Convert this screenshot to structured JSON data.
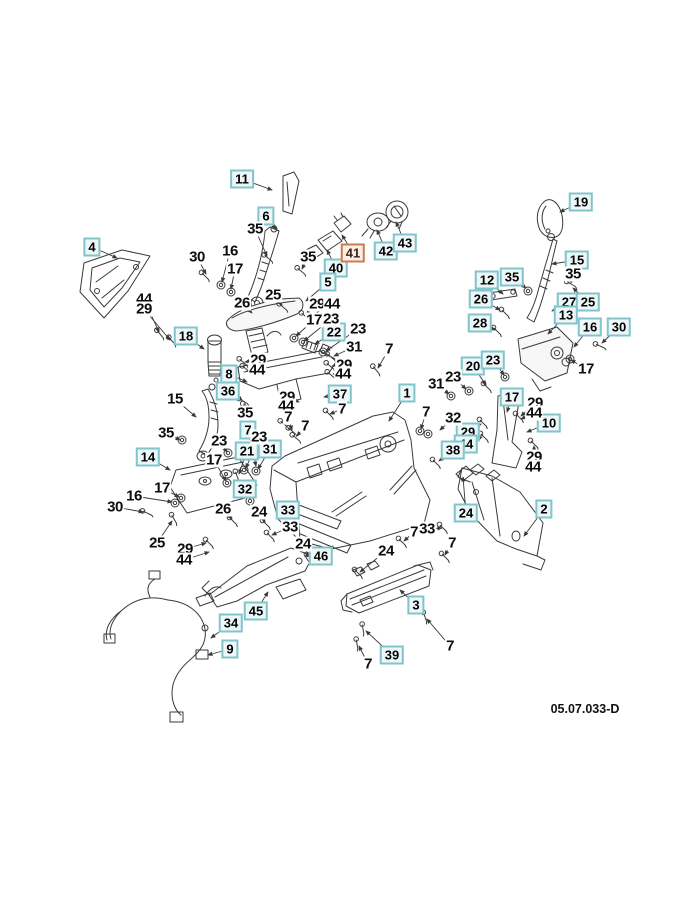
{
  "drawing_number": "05.07.033-D",
  "colors": {
    "box_border": "#82c4cc",
    "box_background": "#eef7f8",
    "highlight_border": "#cd7b4e",
    "highlight_background": "#f9efe7",
    "line": "#3a3a3a",
    "page_background": "#ffffff"
  },
  "callouts": [
    {
      "n": "11",
      "x": 242,
      "y": 179,
      "s": "b",
      "lx": 272,
      "ly": 190
    },
    {
      "n": "6",
      "x": 266,
      "y": 216,
      "s": "b",
      "lx": 276,
      "ly": 229
    },
    {
      "n": "4",
      "x": 92,
      "y": 247,
      "s": "b",
      "lx": 117,
      "ly": 258
    },
    {
      "n": "40",
      "x": 336,
      "y": 268,
      "s": "b",
      "lx": 327,
      "ly": 250
    },
    {
      "n": "41",
      "x": 353,
      "y": 253,
      "s": "h",
      "lx": 342,
      "ly": 235
    },
    {
      "n": "42",
      "x": 386,
      "y": 251,
      "s": "b",
      "lx": 377,
      "ly": 230
    },
    {
      "n": "43",
      "x": 405,
      "y": 243,
      "s": "b",
      "lx": 396,
      "ly": 222
    },
    {
      "n": "19",
      "x": 581,
      "y": 202,
      "s": "b",
      "lx": 560,
      "ly": 212
    },
    {
      "n": "5",
      "x": 328,
      "y": 282,
      "s": "b",
      "lx": 306,
      "ly": 301
    },
    {
      "n": "15",
      "x": 577,
      "y": 260,
      "s": "b",
      "lx": 552,
      "ly": 264
    },
    {
      "n": "35",
      "x": 512,
      "y": 277,
      "s": "b",
      "lx": 526,
      "ly": 288
    },
    {
      "n": "12",
      "x": 487,
      "y": 280,
      "s": "b",
      "lx": 503,
      "ly": 294
    },
    {
      "n": "26",
      "x": 481,
      "y": 299,
      "s": "b",
      "lx": 500,
      "ly": 310
    },
    {
      "n": "27",
      "x": 569,
      "y": 302,
      "s": "b",
      "lx": 552,
      "ly": 311
    },
    {
      "n": "25",
      "x": 588,
      "y": 302,
      "s": "b",
      "lx": 573,
      "ly": 288
    },
    {
      "n": "28",
      "x": 480,
      "y": 323,
      "s": "b",
      "lx": 495,
      "ly": 330
    },
    {
      "n": "13",
      "x": 566,
      "y": 315,
      "s": "b",
      "lx": 548,
      "ly": 334
    },
    {
      "n": "16",
      "x": 590,
      "y": 327,
      "s": "b",
      "lx": 574,
      "ly": 347
    },
    {
      "n": "30",
      "x": 619,
      "y": 327,
      "s": "b",
      "lx": 602,
      "ly": 343
    },
    {
      "n": "18",
      "x": 186,
      "y": 336,
      "s": "b",
      "lx": 204,
      "ly": 349
    },
    {
      "n": "22",
      "x": 334,
      "y": 332,
      "s": "b",
      "lx": 315,
      "ly": 344
    },
    {
      "n": "8",
      "x": 229,
      "y": 374,
      "s": "b",
      "lx": 247,
      "ly": 382
    },
    {
      "n": "36",
      "x": 228,
      "y": 391,
      "s": "b",
      "lx": 242,
      "ly": 400
    },
    {
      "n": "37",
      "x": 340,
      "y": 394,
      "s": "b",
      "lx": 324,
      "ly": 397
    },
    {
      "n": "1",
      "x": 407,
      "y": 393,
      "s": "b",
      "lx": 389,
      "ly": 421
    },
    {
      "n": "20",
      "x": 473,
      "y": 366,
      "s": "b",
      "lx": 486,
      "ly": 385
    },
    {
      "n": "23",
      "x": 493,
      "y": 360,
      "s": "b",
      "lx": 504,
      "ly": 375
    },
    {
      "n": "17",
      "x": 512,
      "y": 397,
      "s": "b",
      "lx": 507,
      "ly": 412
    },
    {
      "n": "10",
      "x": 549,
      "y": 423,
      "s": "b",
      "lx": 527,
      "ly": 432
    },
    {
      "n": "29",
      "x": 468,
      "y": 432,
      "s": "b",
      "lx": 481,
      "ly": 424
    },
    {
      "n": "44",
      "x": 466,
      "y": 444,
      "s": "b",
      "lx": 482,
      "ly": 437
    },
    {
      "n": "38",
      "x": 453,
      "y": 450,
      "s": "b",
      "lx": 439,
      "ly": 461
    },
    {
      "n": "14",
      "x": 148,
      "y": 457,
      "s": "b",
      "lx": 170,
      "ly": 470
    },
    {
      "n": "7",
      "x": 248,
      "y": 430,
      "s": "b",
      "lx": 256,
      "ly": 466
    },
    {
      "n": "21",
      "x": 247,
      "y": 451,
      "s": "b",
      "lx": 239,
      "ly": 474
    },
    {
      "n": "31",
      "x": 270,
      "y": 449,
      "s": "b",
      "lx": 258,
      "ly": 469
    },
    {
      "n": "32",
      "x": 245,
      "y": 489,
      "s": "b",
      "lx": 250,
      "ly": 499
    },
    {
      "n": "33",
      "x": 288,
      "y": 510,
      "s": "b",
      "lx": 299,
      "ly": 514
    },
    {
      "n": "2",
      "x": 544,
      "y": 509,
      "s": "b",
      "lx": 524,
      "ly": 536
    },
    {
      "n": "24",
      "x": 466,
      "y": 513,
      "s": "b",
      "lx": 463,
      "ly": 477
    },
    {
      "n": "46",
      "x": 321,
      "y": 556,
      "s": "b",
      "lx": 333,
      "ly": 546
    },
    {
      "n": "45",
      "x": 256,
      "y": 611,
      "s": "b",
      "lx": 268,
      "ly": 592
    },
    {
      "n": "34",
      "x": 231,
      "y": 623,
      "s": "b",
      "lx": 211,
      "ly": 638
    },
    {
      "n": "9",
      "x": 230,
      "y": 649,
      "s": "b",
      "lx": 208,
      "ly": 655
    },
    {
      "n": "3",
      "x": 416,
      "y": 605,
      "s": "b",
      "lx": 400,
      "ly": 590
    },
    {
      "n": "39",
      "x": 392,
      "y": 655,
      "s": "b",
      "lx": 366,
      "ly": 631
    },
    {
      "n": "30",
      "x": 197,
      "y": 257,
      "s": "p",
      "lx": 206,
      "ly": 274
    },
    {
      "n": "16",
      "x": 230,
      "y": 251,
      "s": "p",
      "lx": 222,
      "ly": 282
    },
    {
      "n": "17",
      "x": 235,
      "y": 269,
      "s": "p",
      "lx": 231,
      "ly": 289
    },
    {
      "n": "35",
      "x": 255,
      "y": 229,
      "s": "p",
      "lx": 267,
      "ly": 256
    },
    {
      "n": "35",
      "x": 308,
      "y": 257,
      "s": "p",
      "lx": 302,
      "ly": 269
    },
    {
      "n": "25",
      "x": 273,
      "y": 295,
      "s": "p",
      "lx": 282,
      "ly": 305
    },
    {
      "n": "26",
      "x": 242,
      "y": 303,
      "s": "p",
      "lx": 252,
      "ly": 313
    },
    {
      "n": "29",
      "x": 317,
      "y": 304,
      "s": "p",
      "lx": 306,
      "ly": 315
    },
    {
      "n": "44",
      "x": 332,
      "y": 304,
      "s": "p",
      "lx": 309,
      "ly": 317
    },
    {
      "n": "17",
      "x": 314,
      "y": 320,
      "s": "p",
      "lx": 296,
      "ly": 336
    },
    {
      "n": "23",
      "x": 331,
      "y": 319,
      "s": "p",
      "lx": 304,
      "ly": 341
    },
    {
      "n": "23",
      "x": 358,
      "y": 329,
      "s": "p",
      "lx": 326,
      "ly": 351
    },
    {
      "n": "31",
      "x": 354,
      "y": 347,
      "s": "p",
      "lx": 334,
      "ly": 356
    },
    {
      "n": "44",
      "x": 144,
      "y": 299,
      "s": "p",
      "lx": 159,
      "ly": 332
    },
    {
      "n": "29",
      "x": 144,
      "y": 309,
      "s": "p",
      "lx": 170,
      "ly": 340
    },
    {
      "n": "29",
      "x": 258,
      "y": 360,
      "s": "p",
      "lx": 245,
      "ly": 362
    },
    {
      "n": "44",
      "x": 257,
      "y": 370,
      "s": "p",
      "lx": 248,
      "ly": 369
    },
    {
      "n": "29",
      "x": 344,
      "y": 365,
      "s": "p",
      "lx": 332,
      "ly": 366
    },
    {
      "n": "44",
      "x": 343,
      "y": 374,
      "s": "p",
      "lx": 333,
      "ly": 374
    },
    {
      "n": "7",
      "x": 389,
      "y": 349,
      "s": "p",
      "lx": 378,
      "ly": 368
    },
    {
      "n": "15",
      "x": 175,
      "y": 399,
      "s": "p",
      "lx": 196,
      "ly": 417
    },
    {
      "n": "29",
      "x": 287,
      "y": 397,
      "s": "p",
      "lx": 299,
      "ly": 402
    },
    {
      "n": "44",
      "x": 286,
      "y": 406,
      "s": "p"
    },
    {
      "n": "35",
      "x": 245,
      "y": 413,
      "s": "p",
      "lx": 247,
      "ly": 406
    },
    {
      "n": "7",
      "x": 288,
      "y": 417,
      "s": "p",
      "lx": 292,
      "ly": 430
    },
    {
      "n": "7",
      "x": 305,
      "y": 426,
      "s": "p",
      "lx": 297,
      "ly": 436
    },
    {
      "n": "7",
      "x": 342,
      "y": 409,
      "s": "p",
      "lx": 330,
      "ly": 414
    },
    {
      "n": "35",
      "x": 166,
      "y": 433,
      "s": "p",
      "lx": 180,
      "ly": 440
    },
    {
      "n": "23",
      "x": 219,
      "y": 441,
      "s": "p",
      "lx": 227,
      "ly": 452
    },
    {
      "n": "23",
      "x": 259,
      "y": 437,
      "s": "p",
      "lx": 246,
      "ly": 468
    },
    {
      "n": "31",
      "x": 436,
      "y": 384,
      "s": "p",
      "lx": 449,
      "ly": 394
    },
    {
      "n": "23",
      "x": 453,
      "y": 377,
      "s": "p",
      "lx": 466,
      "ly": 389
    },
    {
      "n": "7",
      "x": 426,
      "y": 412,
      "s": "p",
      "lx": 421,
      "ly": 429
    },
    {
      "n": "32",
      "x": 453,
      "y": 418,
      "s": "p",
      "lx": 440,
      "ly": 430
    },
    {
      "n": "17",
      "x": 214,
      "y": 460,
      "s": "p",
      "lx": 226,
      "ly": 481
    },
    {
      "n": "17",
      "x": 162,
      "y": 488,
      "s": "p",
      "lx": 179,
      "ly": 497
    },
    {
      "n": "16",
      "x": 134,
      "y": 496,
      "s": "p",
      "lx": 172,
      "ly": 502
    },
    {
      "n": "30",
      "x": 115,
      "y": 507,
      "s": "p",
      "lx": 143,
      "ly": 512
    },
    {
      "n": "26",
      "x": 223,
      "y": 509,
      "s": "p",
      "lx": 232,
      "ly": 519
    },
    {
      "n": "24",
      "x": 259,
      "y": 512,
      "s": "p",
      "lx": 265,
      "ly": 522
    },
    {
      "n": "33",
      "x": 290,
      "y": 527,
      "s": "p",
      "lx": 272,
      "ly": 535
    },
    {
      "n": "25",
      "x": 157,
      "y": 543,
      "s": "p",
      "lx": 172,
      "ly": 521
    },
    {
      "n": "29",
      "x": 185,
      "y": 549,
      "s": "p",
      "lx": 206,
      "ly": 543
    },
    {
      "n": "44",
      "x": 184,
      "y": 560,
      "s": "p",
      "lx": 209,
      "ly": 552
    },
    {
      "n": "24",
      "x": 303,
      "y": 544,
      "s": "p",
      "lx": 309,
      "ly": 557
    },
    {
      "n": "24",
      "x": 386,
      "y": 551,
      "s": "p",
      "lx": 360,
      "ly": 572
    },
    {
      "n": "7",
      "x": 452,
      "y": 543,
      "s": "p",
      "lx": 445,
      "ly": 555
    },
    {
      "n": "7",
      "x": 414,
      "y": 532,
      "s": "p",
      "lx": 404,
      "ly": 541
    },
    {
      "n": "33",
      "x": 427,
      "y": 529,
      "s": "p",
      "lx": 442,
      "ly": 528
    },
    {
      "n": "29",
      "x": 535,
      "y": 403,
      "s": "p",
      "lx": 521,
      "ly": 416
    },
    {
      "n": "44",
      "x": 534,
      "y": 413,
      "s": "p",
      "lx": 521,
      "ly": 419
    },
    {
      "n": "29",
      "x": 534,
      "y": 457,
      "s": "p",
      "lx": 534,
      "ly": 446
    },
    {
      "n": "44",
      "x": 533,
      "y": 467,
      "s": "p",
      "lx": 535,
      "ly": 448
    },
    {
      "n": "17",
      "x": 586,
      "y": 369,
      "s": "p",
      "lx": 571,
      "ly": 360
    },
    {
      "n": "35",
      "x": 573,
      "y": 274,
      "s": "p",
      "lx": 571,
      "ly": 283
    },
    {
      "n": "7",
      "x": 450,
      "y": 646,
      "s": "p",
      "lx": 427,
      "ly": 619
    },
    {
      "n": "7",
      "x": 368,
      "y": 664,
      "s": "p",
      "lx": 359,
      "ly": 646
    }
  ],
  "fasteners": [
    [
      205,
      276,
      45
    ],
    [
      221,
      285,
      0
    ],
    [
      231,
      292,
      0
    ],
    [
      268,
      258,
      40
    ],
    [
      301,
      271,
      40
    ],
    [
      283,
      307,
      40
    ],
    [
      160,
      334,
      50
    ],
    [
      172,
      341,
      50
    ],
    [
      294,
      338,
      0
    ],
    [
      303,
      342,
      0
    ],
    [
      323,
      352,
      0
    ],
    [
      331,
      357,
      40
    ],
    [
      305,
      316,
      40
    ],
    [
      376,
      370,
      50
    ],
    [
      243,
      362,
      40
    ],
    [
      246,
      369,
      40
    ],
    [
      330,
      366,
      40
    ],
    [
      331,
      375,
      40
    ],
    [
      243,
      401,
      30
    ],
    [
      247,
      406,
      30
    ],
    [
      284,
      424,
      40
    ],
    [
      292,
      431,
      40
    ],
    [
      296,
      438,
      40
    ],
    [
      182,
      440,
      0
    ],
    [
      228,
      453,
      0
    ],
    [
      244,
      470,
      0
    ],
    [
      237,
      476,
      70
    ],
    [
      256,
      471,
      0
    ],
    [
      250,
      501,
      0
    ],
    [
      451,
      396,
      0
    ],
    [
      469,
      391,
      0
    ],
    [
      420,
      431,
      0
    ],
    [
      428,
      434,
      0
    ],
    [
      487,
      387,
      45
    ],
    [
      505,
      377,
      0
    ],
    [
      497,
      331,
      45
    ],
    [
      505,
      313,
      45
    ],
    [
      528,
      291,
      0
    ],
    [
      571,
      284,
      30
    ],
    [
      600,
      346,
      25
    ],
    [
      570,
      359,
      0
    ],
    [
      436,
      463,
      45
    ],
    [
      483,
      423,
      45
    ],
    [
      484,
      437,
      45
    ],
    [
      519,
      417,
      45
    ],
    [
      534,
      444,
      45
    ],
    [
      227,
      483,
      0
    ],
    [
      181,
      498,
      0
    ],
    [
      175,
      503,
      0
    ],
    [
      147,
      513,
      25
    ],
    [
      174,
      519,
      60
    ],
    [
      209,
      543,
      45
    ],
    [
      270,
      536,
      45
    ],
    [
      310,
      558,
      45
    ],
    [
      358,
      573,
      45
    ],
    [
      402,
      542,
      45
    ],
    [
      443,
      528,
      45
    ],
    [
      425,
      617,
      70
    ],
    [
      357,
      644,
      80
    ],
    [
      363,
      629,
      80
    ],
    [
      445,
      557,
      45
    ],
    [
      266,
      524,
      45
    ],
    [
      233,
      521,
      45
    ],
    [
      329,
      414,
      45
    ]
  ]
}
